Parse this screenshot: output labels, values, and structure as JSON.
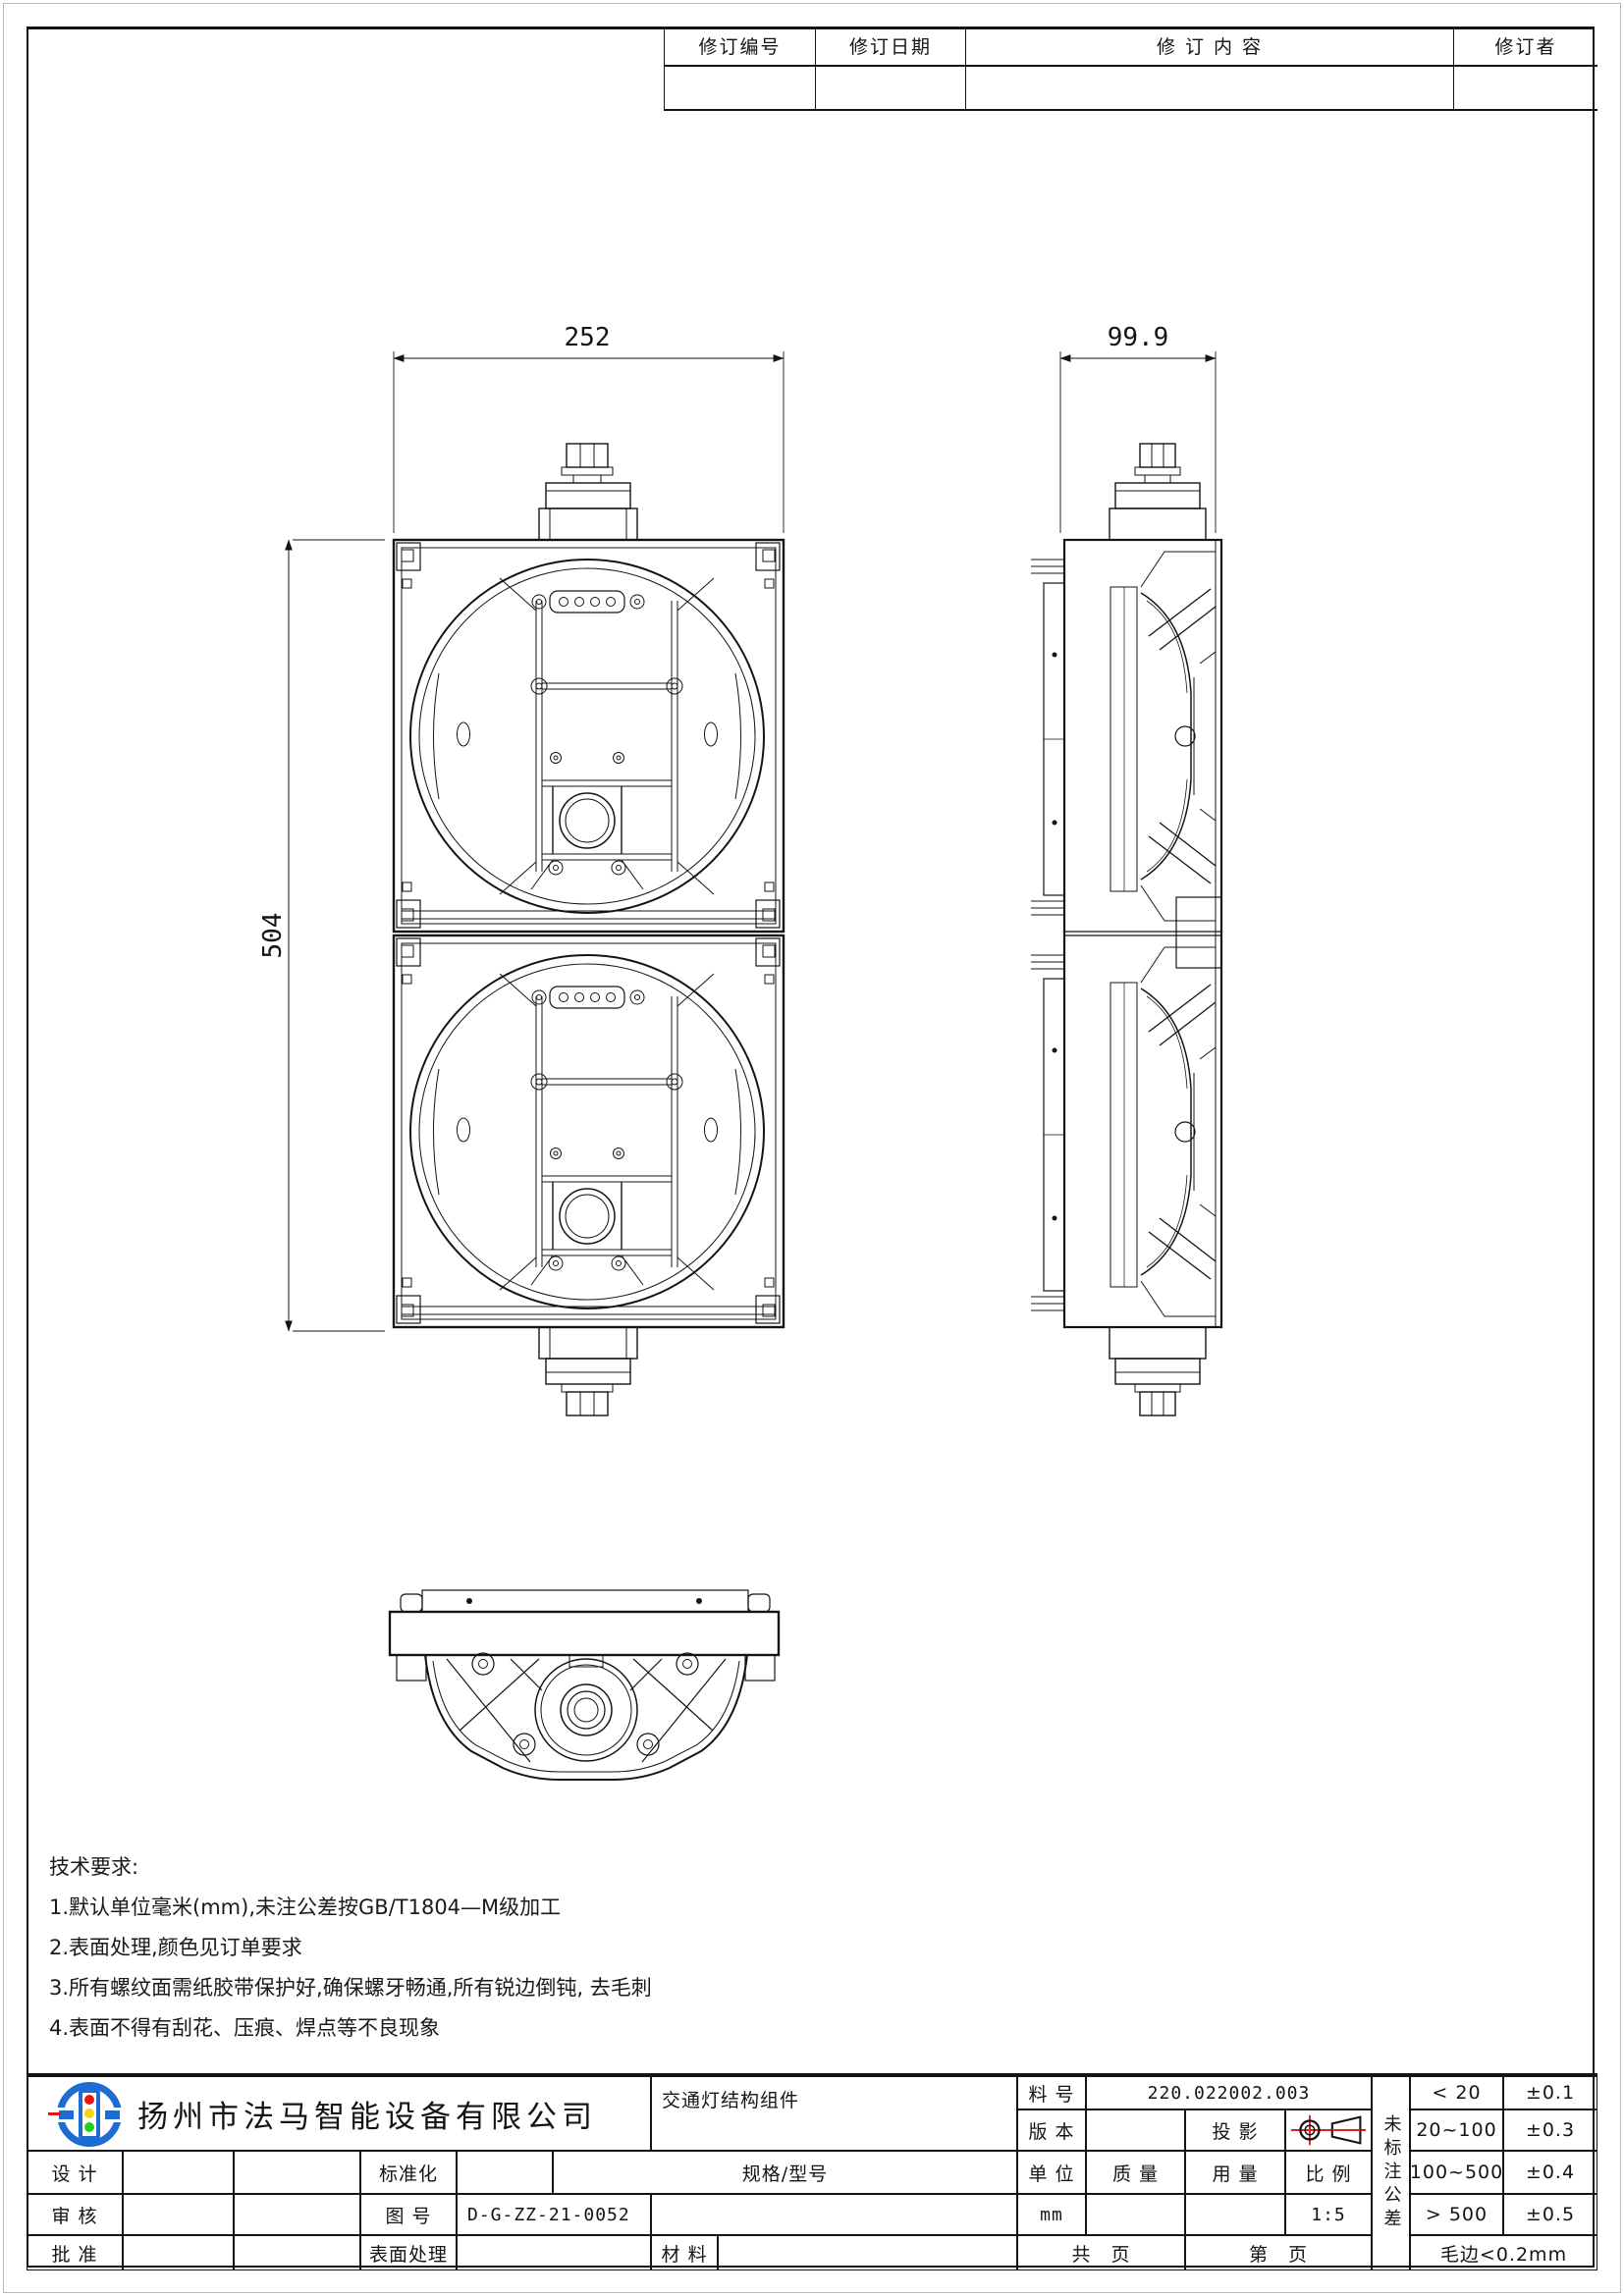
{
  "revision_table": {
    "headers": [
      "修订编号",
      "修订日期",
      "修 订 内 容",
      "修订者"
    ]
  },
  "views": {
    "front": {
      "dim_width": "252",
      "dim_height": "504"
    },
    "side": {
      "dim_width": "99.9"
    }
  },
  "technical_requirements": {
    "title": "技术要求:",
    "items": [
      "1.默认单位毫米(mm),未注公差按GB/T1804—M级加工",
      "2.表面处理,颜色见订单要求",
      "3.所有螺纹面需纸胶带保护好,确保螺牙畅通,所有锐边倒钝, 去毛刺",
      "4.表面不得有刮花、压痕、焊点等不良现象"
    ]
  },
  "title_block": {
    "company": "扬州市法马智能设备有限公司",
    "part_name": "交通灯结构组件",
    "part_no_label": "料 号",
    "part_no": "220.022002.003",
    "version_label": "版 本",
    "projection_label": "投 影",
    "spec_label": "规格/型号",
    "unit_label": "单 位",
    "unit_value": "mm",
    "mass_label": "质 量",
    "usage_label": "用 量",
    "scale_label": "比 例",
    "scale_value": "1:5",
    "design_label": "设 计",
    "standardization_label": "标准化",
    "review_label": "审 核",
    "drawing_no_label": "图 号",
    "drawing_no": "D-G-ZZ-21-0052",
    "approve_label": "批 准",
    "surface_label": "表面处理",
    "material_label": "材 料",
    "total_pages_label": "共　页",
    "page_label": "第　页",
    "unmarked_tolerance": "未标注公差",
    "tolerances": [
      {
        "range": "< 20",
        "value": "±0.1"
      },
      {
        "range": "20~100",
        "value": "±0.3"
      },
      {
        "range": "100~500",
        "value": "±0.4"
      },
      {
        "range": "> 500",
        "value": "±0.5"
      }
    ],
    "burr_note": "毛边<0.2mm",
    "colors": {
      "logo_blue": "#1e6cd2",
      "projection_red": "#e02020",
      "line_black": "#141414"
    }
  }
}
